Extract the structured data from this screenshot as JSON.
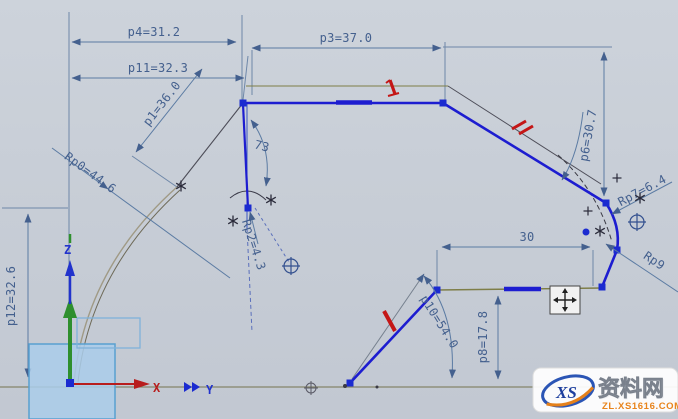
{
  "app": {
    "description": "CAD sketch view with parametric dimensions"
  },
  "dims": {
    "p4": "p4=31.2",
    "p11": "p11=32.3",
    "p1": "p1=36.0",
    "p3": "p3=37.0",
    "p6": "p6=30.7",
    "rp7": "Rp7=6.4",
    "rp9": "Rp9",
    "rp0": "Rp0=44.6",
    "rp2": "Rp2=4.3",
    "angle73": "73",
    "d30": "30",
    "p8": "p8=17.8",
    "p10": "p10=54.0",
    "p12": "p12=32.6"
  },
  "axes": {
    "x": "X",
    "y": "Y",
    "z": "Z"
  },
  "watermark": {
    "logo": "XS",
    "brand": "资料网",
    "domain": "ZL.XS1616.COM"
  },
  "icons": {
    "move_cursor": "four-way move arrows",
    "position_constraint": "circle-plus target",
    "dof_marker": "asterisk star",
    "red_constraint": "red highlight tick"
  },
  "colors": {
    "background": "#c9cfd8",
    "profile": "#1d1dd0",
    "dimension": "#44608e",
    "construction": "#7e7e48",
    "highlight": "#c41616",
    "watermark_accent": "#e8841c"
  }
}
